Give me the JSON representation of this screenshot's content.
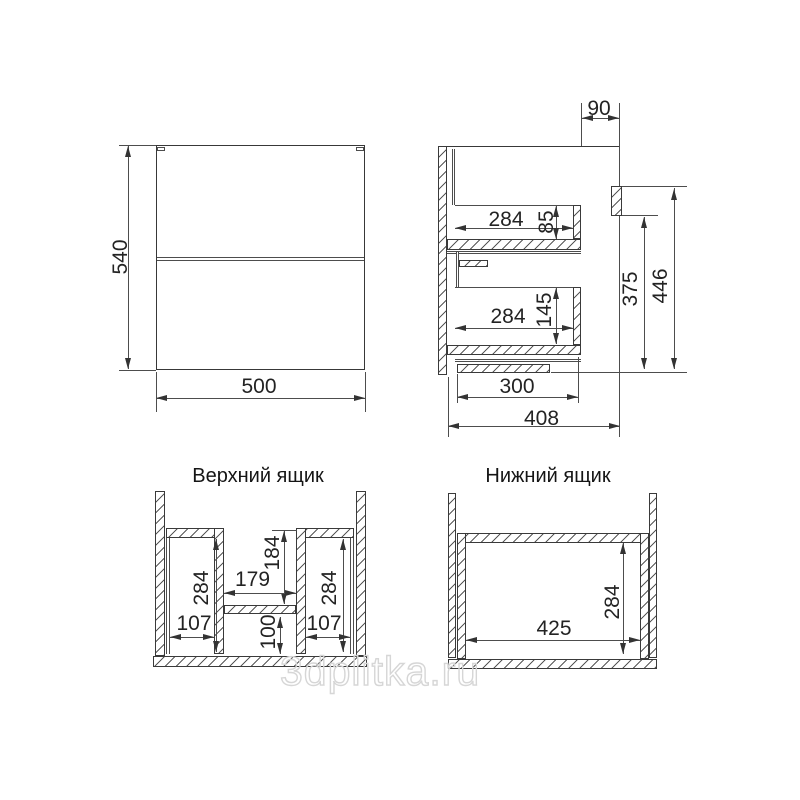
{
  "drawing": {
    "front_view": {
      "height_mm": "540",
      "width_mm": "500"
    },
    "side_view": {
      "facade_offset": "90",
      "upper_drawer_depth": "284",
      "upper_drawer_side_height": "85",
      "lower_drawer_depth": "284",
      "lower_drawer_side_height": "145",
      "hanger_bottom_height": "375",
      "hanger_top_height": "446",
      "bottom_panel_depth": "300",
      "total_depth": "408"
    },
    "upper_drawer_view": {
      "title": "Верхний ящик",
      "left_section_depth": "284",
      "left_section_width": "107",
      "cutout_width": "179",
      "cutout_depth": "184",
      "front_section_depth": "100",
      "right_section_depth": "284",
      "right_section_width": "107"
    },
    "lower_drawer_view": {
      "title": "Нижний ящик",
      "inner_width": "425",
      "inner_depth": "284"
    }
  },
  "watermark": "3dplitka.ru",
  "colors": {
    "object_line": "#383838",
    "dimension_line": "#4d4d4d",
    "hatch_line": "#585858",
    "text": "#232323",
    "watermark": "#d6d6d6",
    "background": "#ffffff"
  }
}
